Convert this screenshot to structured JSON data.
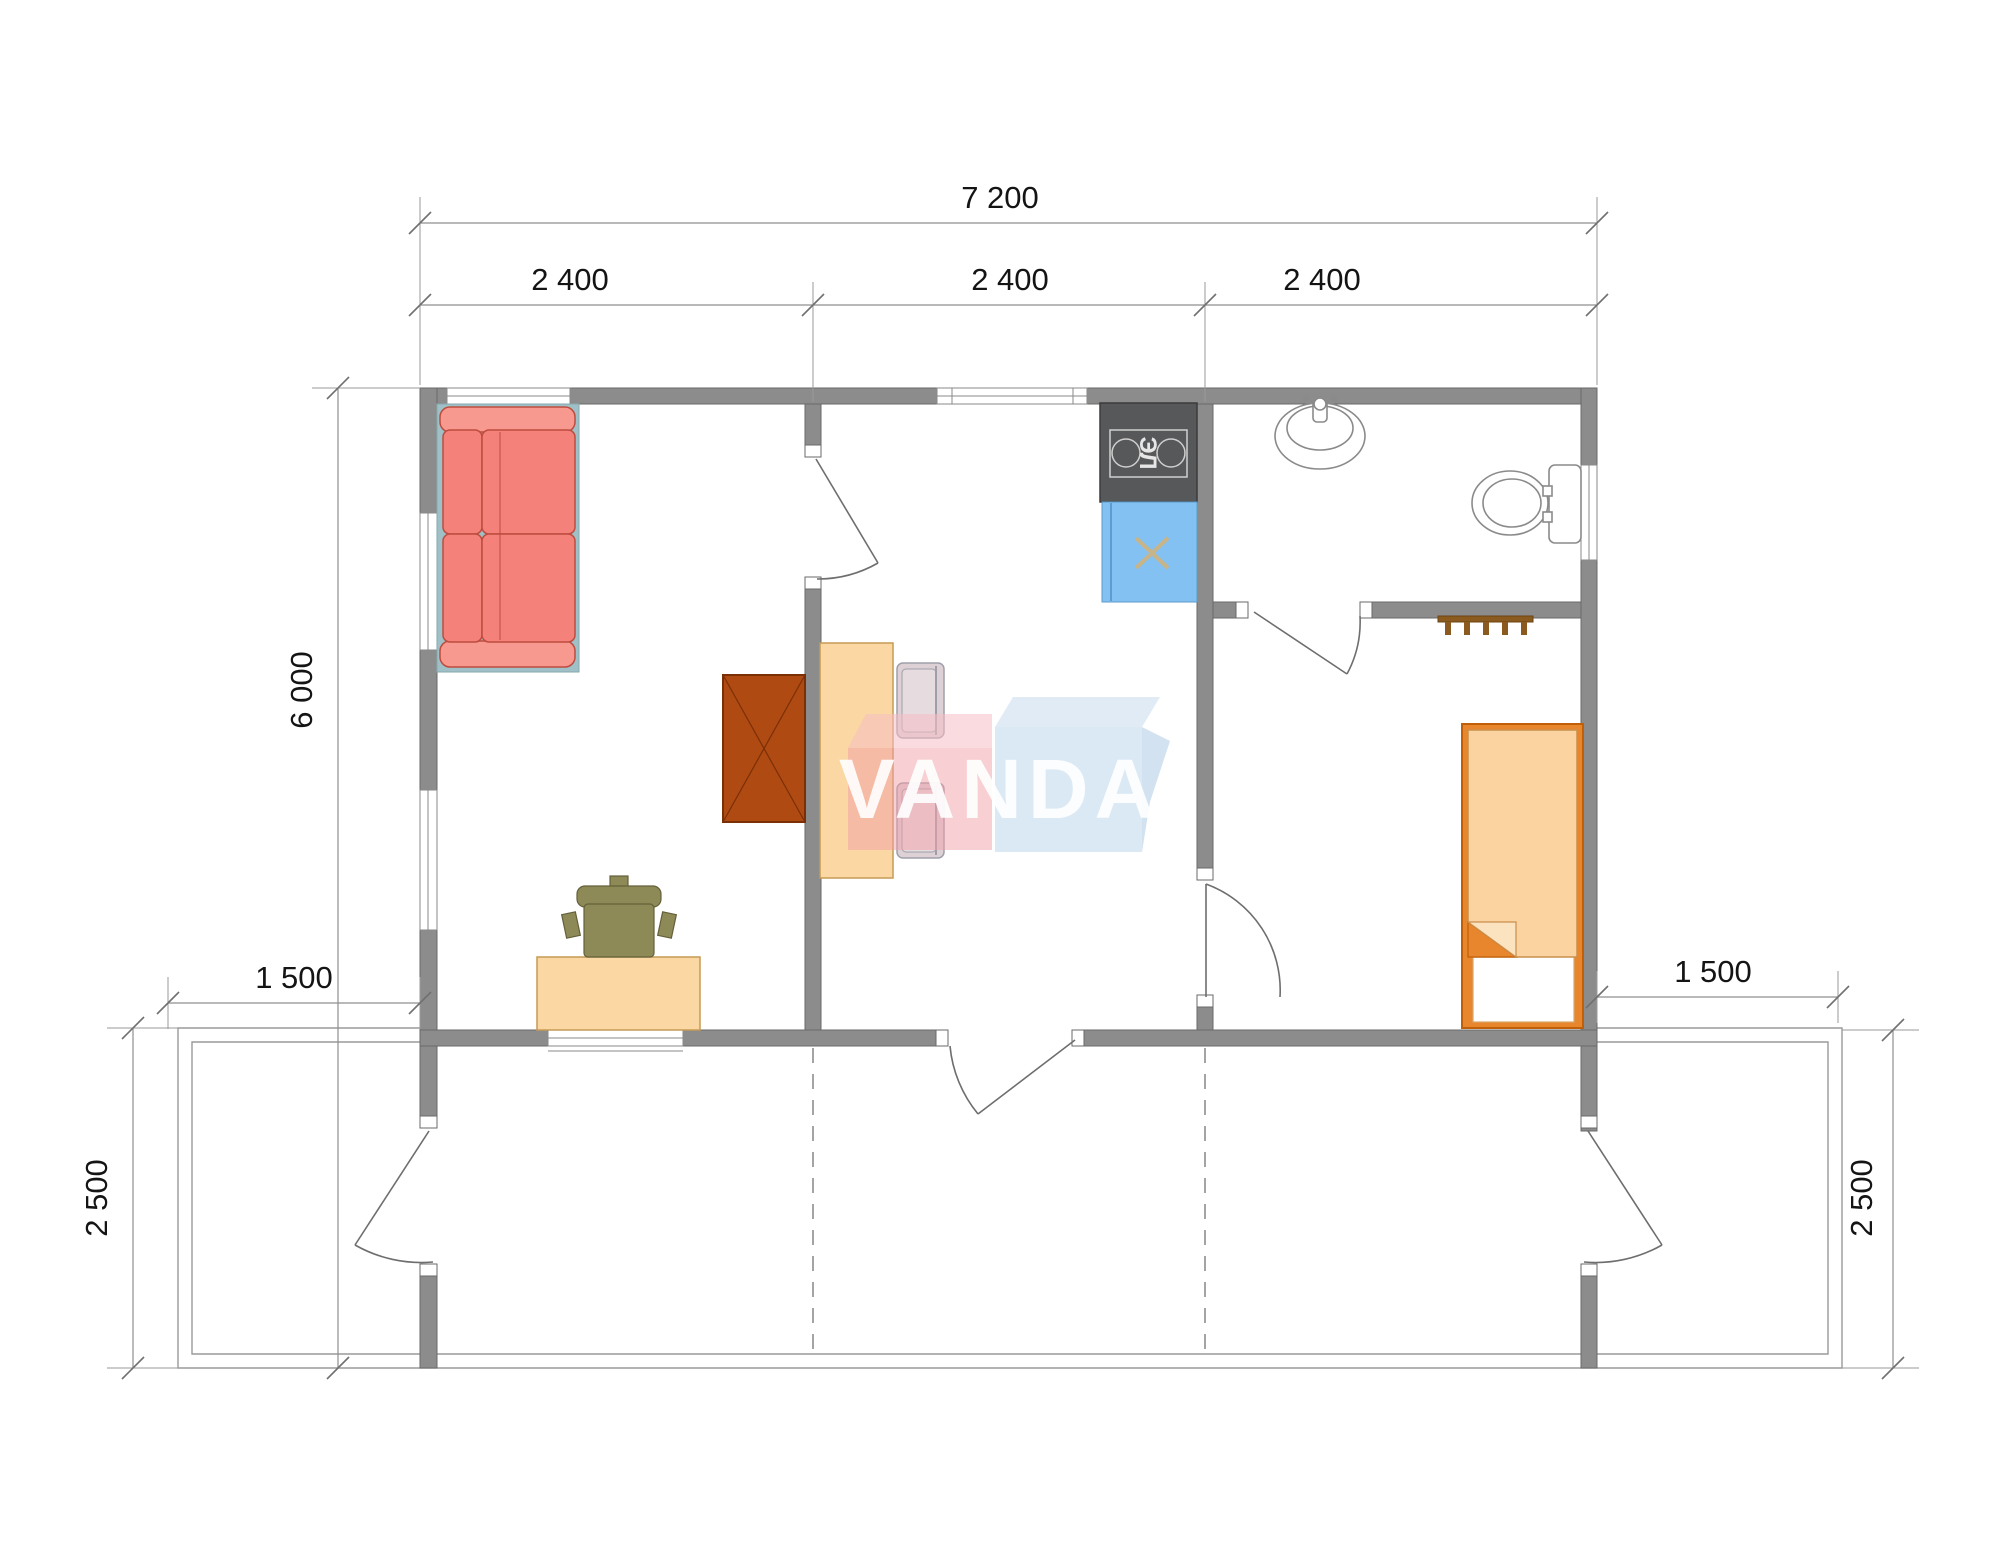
{
  "plan": {
    "brand": "VANDA",
    "dims": {
      "total_width": "7 200",
      "module_1": "2 400",
      "module_2": "2 400",
      "module_3": "2 400",
      "total_depth": "6 000",
      "terrace_offset_left": "1 500",
      "terrace_offset_right": "1 500",
      "terrace_depth_left": "2 500",
      "terrace_depth_right": "2 500"
    },
    "labels": {
      "stove": "ЭЛ"
    },
    "colors": {
      "wall": "#8C8C8C",
      "sofa": "#F4827B",
      "wardrobe": "#B04A13",
      "wood": "#FBD7A3",
      "bed": "#E8862E",
      "sink_cabinet": "#83C1F2",
      "stove": "#57585A",
      "logo_pink": "#F2A0A8",
      "logo_blue": "#BDD7EC"
    }
  }
}
